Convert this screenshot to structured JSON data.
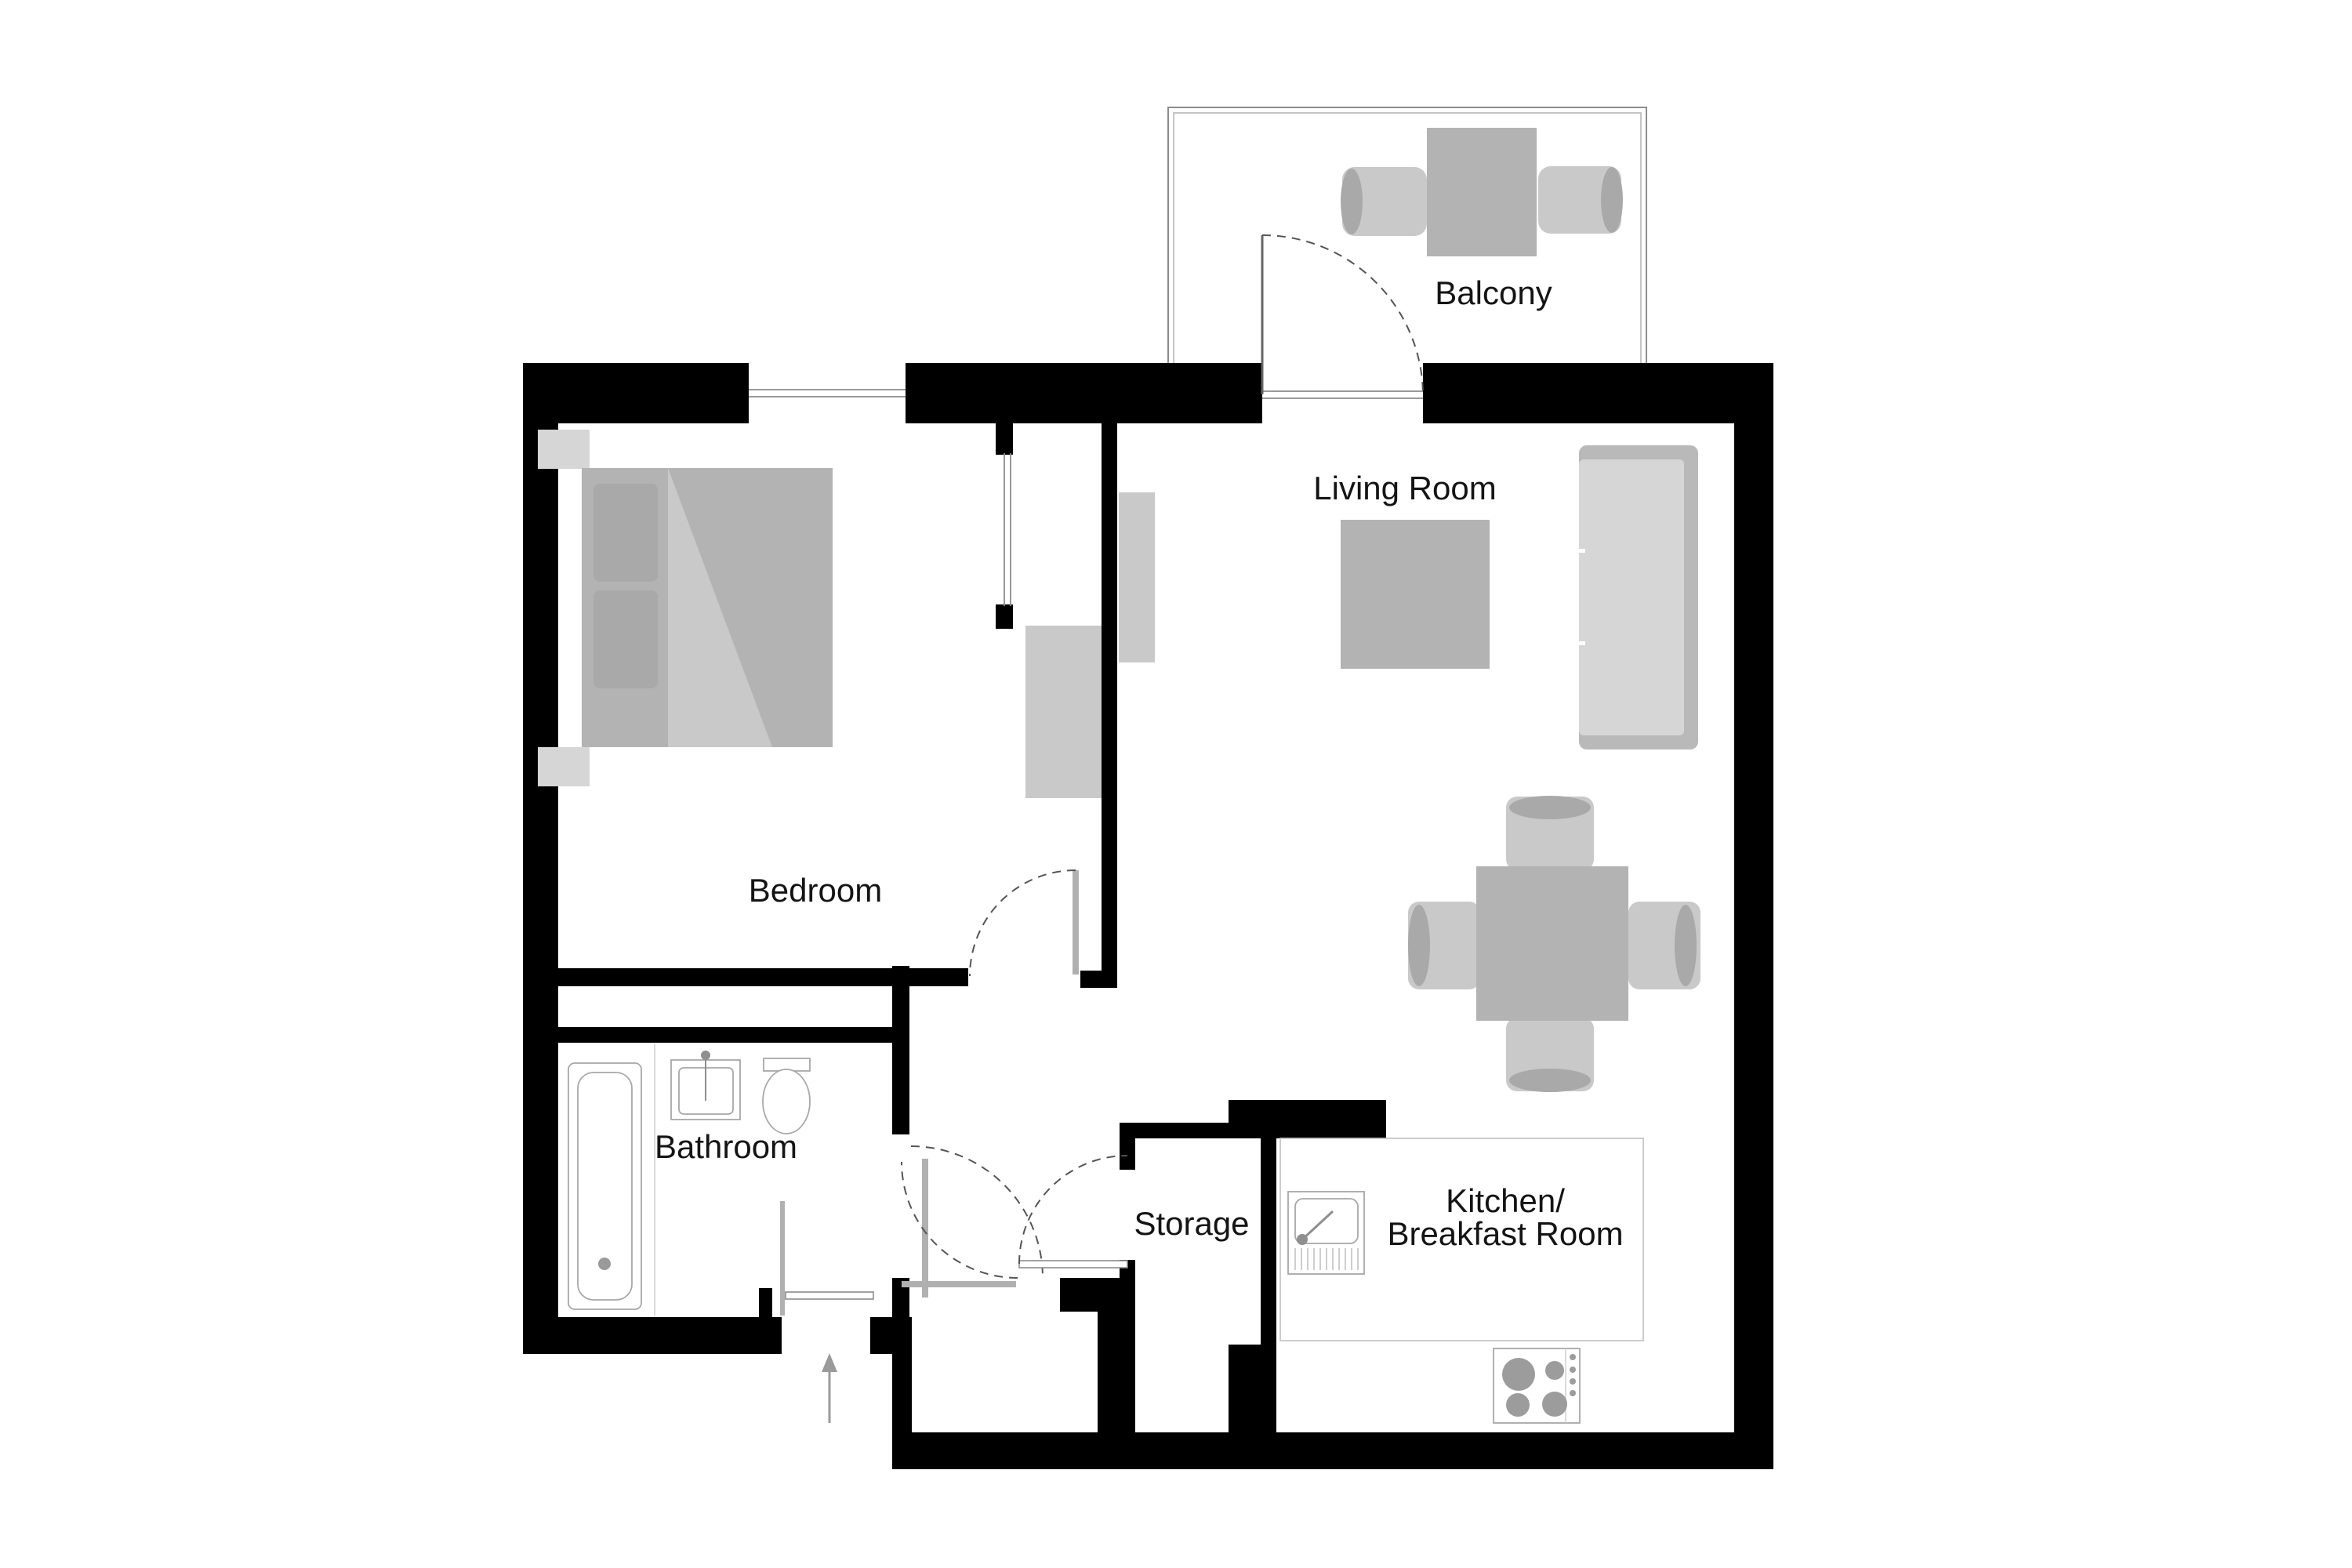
{
  "title": "Apartment floor plan",
  "rooms": {
    "bedroom": {
      "label": "Bedroom"
    },
    "bathroom": {
      "label": "Bathroom"
    },
    "storage": {
      "label": "Storage"
    },
    "living_room": {
      "label": "Living Room"
    },
    "balcony": {
      "label": "Balcony"
    },
    "kitchen": {
      "label_line1": "Kitchen/",
      "label_line2": "Breakfast Room"
    }
  },
  "colors": {
    "background": "#ffffff",
    "wall": "#000000",
    "furniture": "#b3b3b3",
    "furniture_light": "#c9c9c9",
    "furniture_shade": "#a9a9a9",
    "fixture_outline": "#a8a8a8",
    "door_leaf": "#b0b0b0",
    "door_swing": "#555555",
    "label_text": "#141414"
  },
  "symbols": [
    "bed-icon",
    "pillow-icon",
    "nightstand-icon",
    "wardrobe-icon",
    "tv-sideboard-icon",
    "sofa-icon",
    "coffee-table-icon",
    "dining-table-icon",
    "dining-chair-icon",
    "balcony-table-icon",
    "balcony-chair-icon",
    "bathtub-icon",
    "washbasin-icon",
    "toilet-icon",
    "kitchen-sink-icon",
    "stove-icon",
    "window-icon",
    "door-swing-icon",
    "door-leaf-icon",
    "entrance-arrow-icon"
  ],
  "doors": [
    "entrance-door",
    "bedroom-door",
    "bathroom-door",
    "storage-door",
    "balcony-door"
  ],
  "entrance": {
    "direction": "up"
  }
}
